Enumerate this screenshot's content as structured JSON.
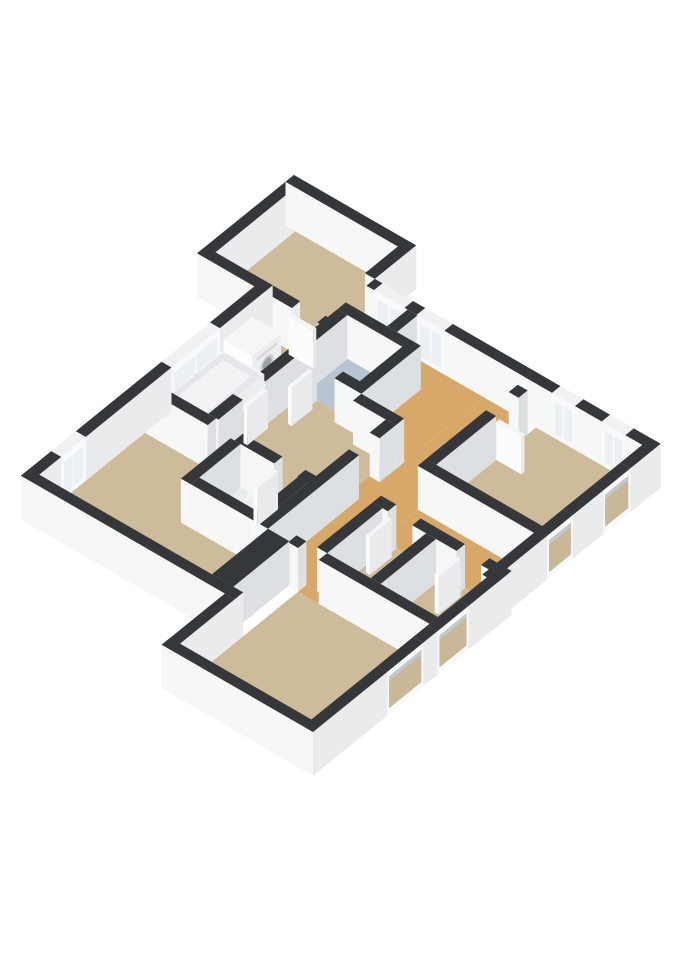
{
  "scene": {
    "width": 679,
    "height": 960,
    "background": "#ffffff"
  },
  "projection": {
    "ux": 0.764,
    "uy": 0.441,
    "vx": -0.645,
    "vy": 0.523,
    "wz": 0.73,
    "cx": 294,
    "cy": 191,
    "wall_height": 60
  },
  "palette": {
    "floor_tan": "#cdbb9a",
    "floor_orange": "#d8a869",
    "floor_blue": "#b9c4d2",
    "floor_void": "#232426",
    "wall_top": "#35383a",
    "face_south": "#f6f7f7",
    "face_east_ext": "#e9ebec",
    "face_east_int": "#dde0e3",
    "frame_top": "#eff1f2",
    "frame": "#f8f9fa",
    "glass": "#eaf0f4",
    "recess_fill": "#c9b897",
    "recess_shadow": "#c2c9ce",
    "leaf_top": "#f4f5f6",
    "leaf_south": "#fbfcfc",
    "leaf_east": "#e8eaec",
    "obj_top": "#f5f6f7",
    "obj_south": "#fdfdfd",
    "obj_east": "#eceeef",
    "basin": "#e4e8ea",
    "basin_inner": "#f1f3f4",
    "washer_slit": "#d4d8db",
    "washer_ring": "#c7cbce",
    "washer_door": "#9aa0a4",
    "seat": "#e9eced"
  },
  "floors": [
    {
      "name": "wing-bedroom",
      "color": "floor_tan",
      "rect": [
        39,
        44,
        173,
        168
      ]
    },
    {
      "name": "stair-void",
      "color": "floor_void",
      "rect": [
        186,
        108,
        240,
        140
      ]
    },
    {
      "name": "bathroom-blue",
      "color": "floor_blue",
      "rect": [
        199,
        153,
        271,
        219
      ]
    },
    {
      "name": "landing",
      "color": "floor_orange",
      "pts": [
        [
          253,
          108
        ],
        [
          340,
          108
        ],
        [
          340,
          232
        ],
        [
          284,
          232
        ],
        [
          284,
          153
        ],
        [
          271,
          153
        ],
        [
          271,
          140
        ],
        [
          253,
          140
        ]
      ]
    },
    {
      "name": "hallway",
      "color": "floor_orange",
      "rect": [
        340,
        108,
        395,
        432
      ]
    },
    {
      "name": "corridor-east",
      "color": "floor_orange",
      "rect": [
        395,
        276,
        547,
        333
      ]
    },
    {
      "name": "corridor-center",
      "color": "floor_tan",
      "pts": [
        [
          199,
          232
        ],
        [
          284,
          232
        ],
        [
          284,
          245
        ],
        [
          340,
          245
        ],
        [
          340,
          353
        ],
        [
          199,
          353
        ]
      ]
    },
    {
      "name": "bathroom-main",
      "color": "floor_tan",
      "rect": [
        114,
        181,
        186,
        353
      ]
    },
    {
      "name": "wc",
      "color": "floor_tan",
      "rect": [
        239,
        366,
        314,
        430
      ]
    },
    {
      "name": "living-room",
      "color": "floor_tan",
      "pts": [
        [
          114,
          366
        ],
        [
          226,
          366
        ],
        [
          226,
          443
        ],
        [
          340,
          443
        ],
        [
          340,
          530
        ],
        [
          114,
          530
        ]
      ]
    },
    {
      "name": "bedroom-right",
      "color": "floor_tan",
      "rect": [
        408,
        108,
        547,
        263
      ]
    },
    {
      "name": "storage-1",
      "color": "floor_tan",
      "rect": [
        408,
        346,
        465,
        432
      ]
    },
    {
      "name": "storage-2",
      "color": "floor_tan",
      "rect": [
        478,
        346,
        547,
        432
      ]
    },
    {
      "name": "bottom-room",
      "color": "floor_tan",
      "rect": [
        381,
        445,
        553,
        628
      ]
    },
    {
      "name": "door-floor-wing",
      "color": "floor_tan",
      "rect": [
        150,
        168,
        182,
        181
      ]
    },
    {
      "name": "door-floor-blue",
      "color": "floor_tan",
      "rect": [
        215,
        219,
        249,
        232
      ]
    },
    {
      "name": "door-floor-bath",
      "color": "floor_tan",
      "rect": [
        186,
        280,
        199,
        315
      ]
    },
    {
      "name": "door-floor-living",
      "color": "floor_tan",
      "rect": [
        196,
        353,
        231,
        366
      ]
    },
    {
      "name": "door-floor-wc",
      "color": "floor_tan",
      "rect": [
        283,
        353,
        313,
        366
      ]
    },
    {
      "name": "door-floor-bedroom",
      "color": "floor_orange",
      "rect": [
        395,
        135,
        408,
        170
      ]
    },
    {
      "name": "door-floor-hall",
      "color": "floor_orange",
      "rect": [
        327,
        270,
        340,
        302
      ]
    },
    {
      "name": "door-floor-storage1",
      "color": "floor_tan",
      "rect": [
        415,
        333,
        447,
        346
      ]
    },
    {
      "name": "door-floor-storage2",
      "color": "floor_tan",
      "rect": [
        505,
        333,
        537,
        346
      ]
    },
    {
      "name": "door-floor-bottom",
      "color": "floor_orange",
      "rect": [
        381,
        432,
        408,
        445
      ]
    }
  ],
  "walls": [
    {
      "name": "wing-north",
      "rect": [
        26,
        31,
        186,
        44
      ],
      "ext": true
    },
    {
      "name": "wing-west",
      "rect": [
        26,
        44,
        39,
        181
      ],
      "ext": true
    },
    {
      "name": "wing-east-upper",
      "rect": [
        173,
        31,
        186,
        95
      ],
      "ext": true
    },
    {
      "name": "wing-south-a",
      "rect": [
        26,
        168,
        150,
        181
      ],
      "ext": true
    },
    {
      "name": "wing-south-b",
      "rect": [
        183,
        168,
        199,
        181
      ],
      "ext": true
    },
    {
      "name": "facade-nw-1",
      "rect": [
        186,
        95,
        196,
        108
      ],
      "ext": true
    },
    {
      "name": "facade-nw-2",
      "rect": [
        236,
        95,
        252,
        108
      ],
      "ext": true
    },
    {
      "name": "facade-nw-3",
      "rect": [
        288,
        95,
        429,
        108
      ],
      "ext": true
    },
    {
      "name": "facade-nw-4",
      "rect": [
        459,
        95,
        494,
        108
      ],
      "ext": true
    },
    {
      "name": "facade-nw-5",
      "rect": [
        525,
        95,
        560,
        108
      ],
      "ext": true
    },
    {
      "name": "facade-w-1",
      "rect": [
        101,
        168,
        114,
        250
      ],
      "ext": true
    },
    {
      "name": "facade-w-2",
      "rect": [
        101,
        325,
        114,
        458
      ],
      "ext": true
    },
    {
      "name": "facade-w-3",
      "rect": [
        101,
        496,
        114,
        543
      ],
      "ext": true
    },
    {
      "name": "facade-s-main",
      "rect": [
        101,
        530,
        381,
        543
      ],
      "ext": true
    },
    {
      "name": "facade-w-bottomwing",
      "rect": [
        368,
        543,
        381,
        641
      ],
      "ext": true
    },
    {
      "name": "facade-s-bottomwing",
      "rect": [
        368,
        628,
        566,
        641
      ],
      "ext": true
    },
    {
      "name": "facade-e-up-1",
      "rect": [
        547,
        95,
        560,
        142
      ],
      "ext": true
    },
    {
      "name": "facade-e-up-2",
      "rect": [
        547,
        184,
        560,
        231
      ],
      "ext": true
    },
    {
      "name": "facade-e-up-3",
      "rect": [
        547,
        271,
        560,
        354
      ],
      "ext": true
    },
    {
      "name": "facade-e-jog",
      "rect": [
        547,
        333,
        566,
        356
      ],
      "ext": true
    },
    {
      "name": "facade-e-low-1",
      "rect": [
        553,
        341,
        566,
        400
      ],
      "ext": true
    },
    {
      "name": "facade-e-low-2",
      "rect": [
        553,
        448,
        566,
        470
      ],
      "ext": true
    },
    {
      "name": "facade-e-low-3",
      "rect": [
        553,
        526,
        566,
        641
      ],
      "ext": true
    },
    {
      "name": "void-east",
      "rect": [
        240,
        108,
        253,
        140
      ],
      "ext": false
    },
    {
      "name": "blue-north",
      "rect": [
        186,
        140,
        284,
        153
      ],
      "ext": false
    },
    {
      "name": "blue-west-a",
      "rect": [
        186,
        153,
        199,
        280
      ],
      "ext": false
    },
    {
      "name": "blue-west-b",
      "rect": [
        186,
        315,
        199,
        353
      ],
      "ext": false
    },
    {
      "name": "blue-east",
      "rect": [
        271,
        140,
        284,
        232
      ],
      "ext": false
    },
    {
      "name": "blue-south-a",
      "rect": [
        199,
        219,
        215,
        232
      ],
      "ext": false
    },
    {
      "name": "blue-south-b",
      "rect": [
        249,
        219,
        284,
        232
      ],
      "ext": false
    },
    {
      "name": "landing-south",
      "rect": [
        284,
        232,
        340,
        245
      ],
      "ext": false
    },
    {
      "name": "center-south-a",
      "rect": [
        114,
        353,
        196,
        366
      ],
      "ext": false
    },
    {
      "name": "center-south-b",
      "rect": [
        231,
        353,
        283,
        366
      ],
      "ext": false
    },
    {
      "name": "center-south-c",
      "rect": [
        313,
        353,
        340,
        366
      ],
      "ext": false
    },
    {
      "name": "wc-west",
      "rect": [
        226,
        366,
        239,
        443
      ],
      "ext": false
    },
    {
      "name": "wc-east",
      "rect": [
        314,
        366,
        327,
        443
      ],
      "ext": false
    },
    {
      "name": "wc-south",
      "rect": [
        239,
        430,
        314,
        443
      ],
      "ext": false
    },
    {
      "name": "hall-west-a",
      "rect": [
        327,
        245,
        340,
        270
      ],
      "ext": false
    },
    {
      "name": "hall-west-b",
      "rect": [
        327,
        302,
        340,
        443
      ],
      "ext": false
    },
    {
      "name": "block-east",
      "rect": [
        340,
        443,
        368,
        530
      ],
      "ext": false
    },
    {
      "name": "bedroom-west-a",
      "rect": [
        395,
        121,
        408,
        135
      ],
      "ext": false
    },
    {
      "name": "bedroom-west-b",
      "rect": [
        395,
        170,
        408,
        263
      ],
      "ext": false
    },
    {
      "name": "bedroom-south",
      "rect": [
        395,
        263,
        553,
        276
      ],
      "ext": false
    },
    {
      "name": "storage-north-a",
      "rect": [
        395,
        333,
        415,
        346
      ],
      "ext": false
    },
    {
      "name": "storage-north-b",
      "rect": [
        447,
        333,
        505,
        346
      ],
      "ext": false
    },
    {
      "name": "storage-north-c",
      "rect": [
        537,
        333,
        547,
        346
      ],
      "ext": false
    },
    {
      "name": "storage-west",
      "rect": [
        395,
        346,
        408,
        432
      ],
      "ext": false
    },
    {
      "name": "storage-mid",
      "rect": [
        465,
        346,
        478,
        432
      ],
      "ext": false
    },
    {
      "name": "bottom-north-a",
      "rect": [
        368,
        432,
        381,
        445
      ],
      "ext": false
    },
    {
      "name": "bottom-north-b",
      "rect": [
        408,
        432,
        553,
        445
      ],
      "ext": false
    }
  ],
  "windows": [
    {
      "name": "window-void",
      "rect": [
        196,
        95,
        236,
        108
      ],
      "face": "s",
      "style": "cut"
    },
    {
      "name": "window-landing",
      "rect": [
        252,
        95,
        288,
        108
      ],
      "face": "s",
      "style": "cut"
    },
    {
      "name": "window-bedroom-1",
      "rect": [
        429,
        95,
        459,
        108
      ],
      "face": "s",
      "style": "cut"
    },
    {
      "name": "window-bedroom-2",
      "rect": [
        494,
        95,
        525,
        108
      ],
      "face": "s",
      "style": "cut"
    },
    {
      "name": "window-bath-tub",
      "rect": [
        101,
        250,
        114,
        325
      ],
      "face": "e",
      "style": "cut"
    },
    {
      "name": "window-living-small",
      "rect": [
        101,
        458,
        114,
        496
      ],
      "face": "e",
      "style": "cut"
    },
    {
      "name": "window-east-up-1",
      "rect": [
        547,
        142,
        560,
        184
      ],
      "face": "e",
      "style": "recessed"
    },
    {
      "name": "window-east-up-2",
      "rect": [
        547,
        231,
        560,
        271
      ],
      "face": "e",
      "style": "recessed"
    },
    {
      "name": "window-east-low-1",
      "rect": [
        553,
        400,
        566,
        448
      ],
      "face": "e",
      "style": "recessed"
    },
    {
      "name": "window-east-low-2",
      "rect": [
        553,
        470,
        566,
        526
      ],
      "face": "e",
      "style": "recessed"
    }
  ],
  "objects": [
    {
      "name": "washing-machine",
      "type": "washer",
      "rect": [
        114,
        200,
        152,
        244
      ],
      "h": 40
    },
    {
      "name": "bathtub",
      "type": "tub",
      "rect": [
        114,
        245,
        168,
        342
      ],
      "h": 26
    },
    {
      "name": "toilet-tank",
      "type": "box",
      "rect": [
        244,
        366,
        270,
        377
      ],
      "h": 34
    },
    {
      "name": "toilet-bowl",
      "type": "bowl",
      "rect": [
        246,
        377,
        270,
        403
      ],
      "h": 20
    }
  ],
  "door_leaves": [
    {
      "name": "leaf-wing",
      "rect": [
        150,
        181,
        182,
        186
      ]
    },
    {
      "name": "leaf-bath",
      "rect": [
        199,
        282,
        204,
        314
      ]
    },
    {
      "name": "leaf-blue",
      "rect": [
        215,
        232,
        220,
        264
      ]
    },
    {
      "name": "leaf-bedroom",
      "rect": [
        408,
        165,
        441,
        170
      ]
    },
    {
      "name": "leaf-storage1",
      "rect": [
        415,
        346,
        420,
        380
      ]
    },
    {
      "name": "leaf-storage2",
      "rect": [
        505,
        346,
        510,
        380
      ]
    },
    {
      "name": "leaf-wc",
      "rect": [
        283,
        366,
        288,
        398
      ]
    }
  ]
}
